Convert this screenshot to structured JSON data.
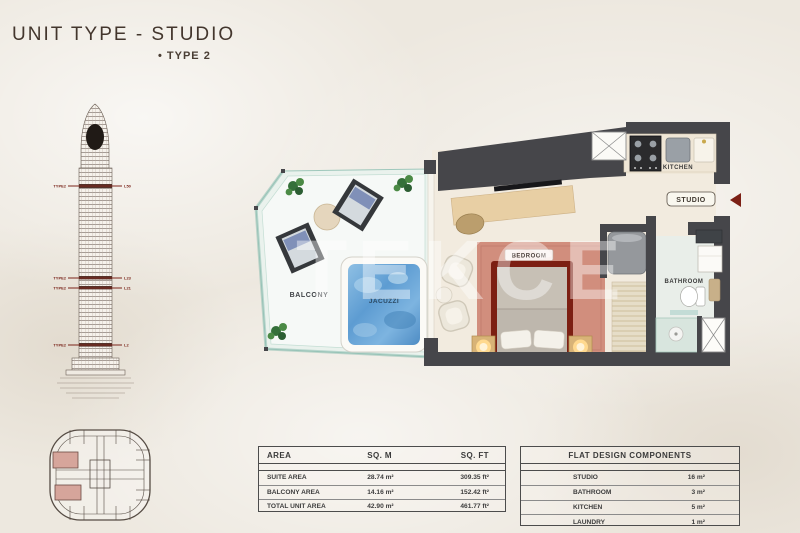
{
  "header": {
    "title": "UNIT TYPE - STUDIO",
    "subtitle": "• TYPE 2"
  },
  "watermark": "TEKCE",
  "tower": {
    "markers": [
      {
        "left": "TYPE2",
        "right": "L50"
      },
      {
        "left": "TYPE2",
        "right": "L23"
      },
      {
        "left": "TYPE2",
        "right": "L21"
      },
      {
        "left": "TYPE2",
        "right": "L2"
      }
    ]
  },
  "floorplan": {
    "labels": {
      "balcony": "BALCONY",
      "jacuzzi": "JACUZZI",
      "bedroom": "BEDROOM",
      "kitchen": "KITCHEN",
      "studio": "STUDIO",
      "bathroom": "BATHROOM"
    }
  },
  "area_table": {
    "headers": [
      "AREA",
      "SQ. M",
      "SQ. FT"
    ],
    "rows": [
      {
        "name": "SUITE AREA",
        "sqm": "28.74 m²",
        "sqft": "309.35 ft²"
      },
      {
        "name": "BALCONY AREA",
        "sqm": "14.16 m²",
        "sqft": "152.42 ft²"
      },
      {
        "name": "TOTAL UNIT AREA",
        "sqm": "42.90 m²",
        "sqft": "461.77 ft²"
      }
    ]
  },
  "components_table": {
    "title": "FLAT DESIGN COMPONENTS",
    "rows": [
      {
        "name": "STUDIO",
        "value": "16 m²"
      },
      {
        "name": "BATHROOM",
        "value": "3 m²"
      },
      {
        "name": "KITCHEN",
        "value": "5 m²"
      },
      {
        "name": "LAUNDRY",
        "value": "1 m²"
      }
    ]
  },
  "colors": {
    "wall": "#46464a",
    "accent_red": "#7b2015",
    "jacuzzi_blue": "#6aa6d8",
    "rug_salmon": "#d18e7d",
    "glass_teal": "#a9cdbf"
  }
}
